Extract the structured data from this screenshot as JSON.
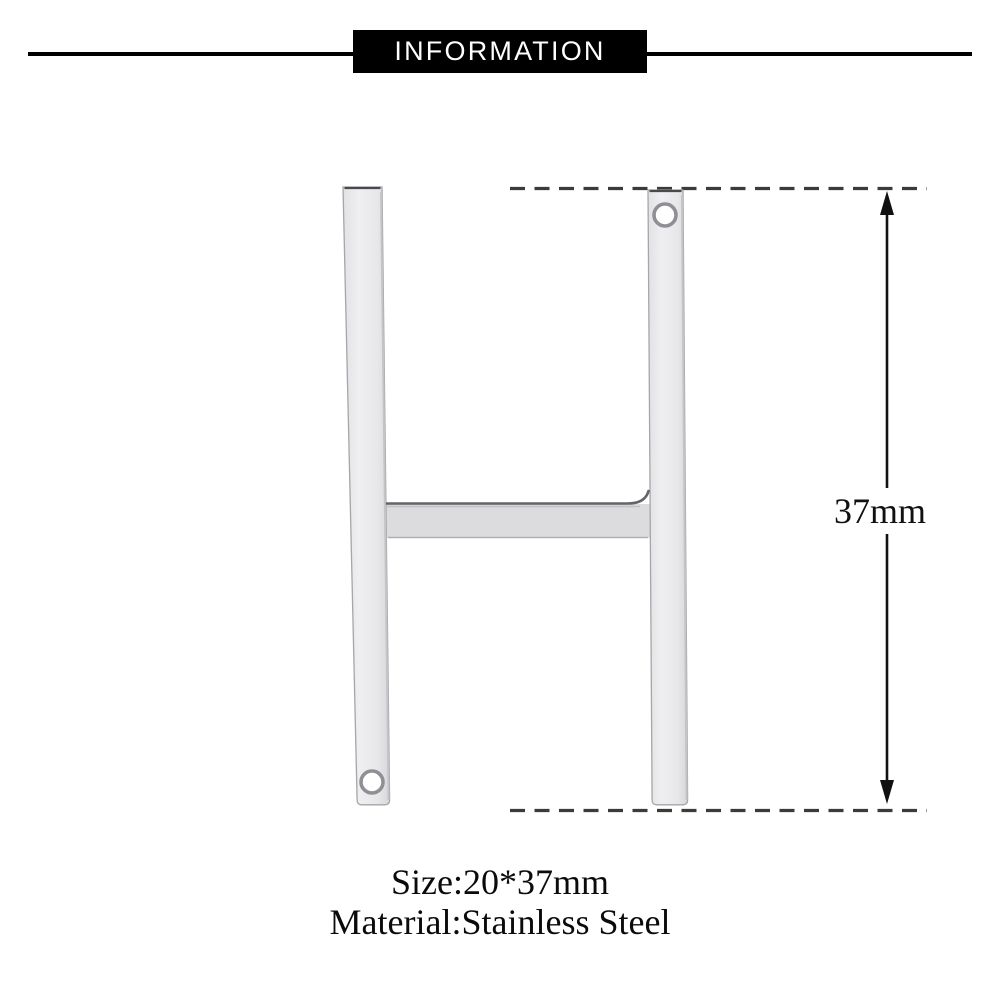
{
  "header": {
    "title": "INFORMATION"
  },
  "diagram": {
    "pendant_letter": "H",
    "dimension_label": "37mm",
    "hole_count": 2
  },
  "details": {
    "size_label": "Size:20*37mm",
    "material_label": "Material:Stainless Steel"
  },
  "colors": {
    "header_bg": "#000000",
    "header_text": "#ffffff",
    "dash_line": "#3b3b3b",
    "arrow": "#111111",
    "metal_fill": "#eaeaec",
    "metal_crossbar_fill": "#dcdcde",
    "metal_edge": "#a6a6aa",
    "metal_shadow": "#4a4a4e",
    "text": "#0b0b0b"
  }
}
